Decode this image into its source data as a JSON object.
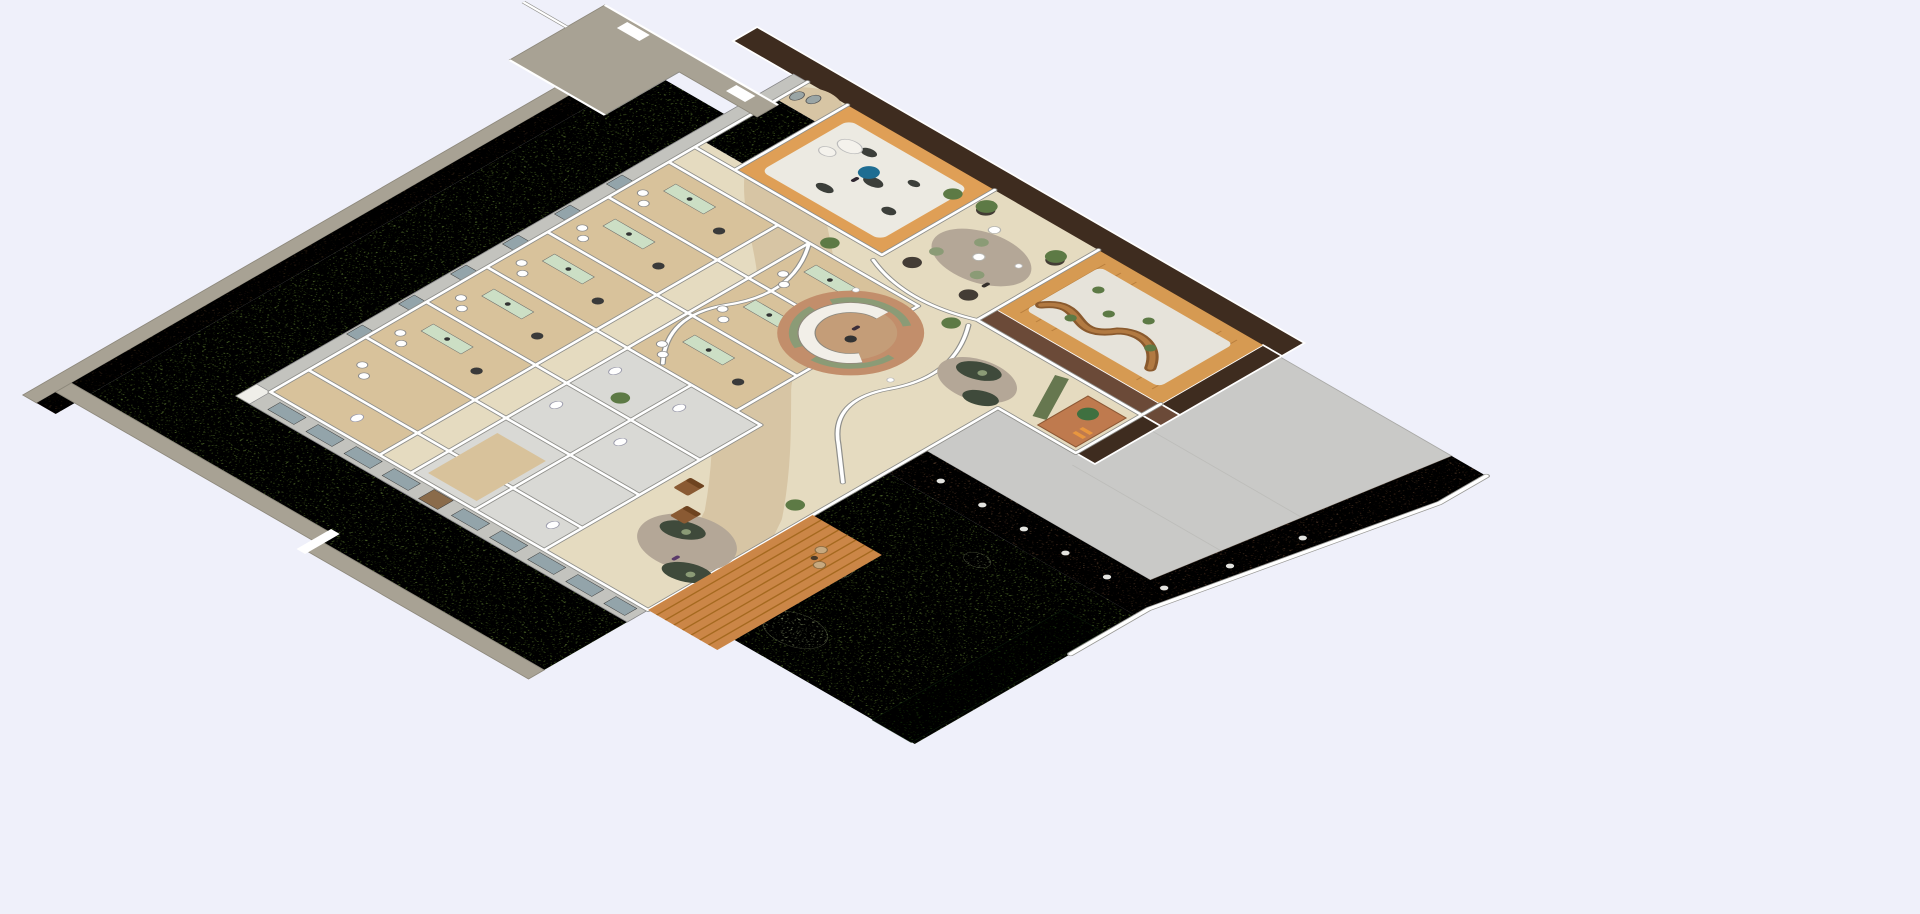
{
  "scene": {
    "type": "isometric-architectural-floor-plan-render",
    "subject": "single-storey clinic cutaway with consult-room wing, central lobby, circular reception desk, zen garden room, lounge, gravel courtyard, rear garden, concrete plaza and walled site perimeter",
    "visible_text": []
  },
  "palette": {
    "bg": "#eff0fa",
    "plaza": "#c9c9c7",
    "grass": "#7fa24b",
    "grassLight": "#b9ca92",
    "hedge": "#3a6022",
    "taupe": "#a8a294",
    "fenceBrown": "#55402c",
    "brickDark": "#3e2c1f",
    "brickRed": "#6b4a38",
    "extWall": "#c3c3be",
    "wallEdge": "#8f8f8b",
    "floorBeige": "#e5dbc0",
    "floorAccent": "#d7c5a4",
    "floorWood": "#d8c29b",
    "floorGray": "#d9d9d5",
    "gravel": "#eceae2",
    "courtGravel": "#e6e3da",
    "courtWood": "#d69a52",
    "zenWood": "#df9f56",
    "deck": "#cb8647",
    "deckLine": "#a5691f",
    "pebble": "#7b5a44",
    "rugTerra": "#c28e6b",
    "rugInner": "#c49d78",
    "rugTaupe": "#b4a797",
    "deskGreen": "#ccdfc5",
    "benchWood": "#8a5a2e",
    "sofaDark": "#3f4a3b",
    "chairBrown": "#8a5a33",
    "chairSage": "#8b9b76",
    "cabinetTerra": "#bf7a4e",
    "accentBlue": "#1e6d92",
    "olivePartition": "#66774f",
    "rock": "#3c3f3a",
    "plant": "#5d7a45",
    "white": "#ffffff",
    "window": "#93a4aa"
  },
  "zones": [
    {
      "name": "perimeter-fence-nw",
      "color_key": "fenceBrown"
    },
    {
      "name": "perimeter-fence-sw",
      "color_key": "taupe"
    },
    {
      "name": "lawn-l-strip",
      "color_key": "grass"
    },
    {
      "name": "entry-walkway",
      "color_key": "taupe"
    },
    {
      "name": "zen-garden-room",
      "color_key": "gravel"
    },
    {
      "name": "lounge-cafe",
      "color_key": "floorBeige"
    },
    {
      "name": "gravel-courtyard",
      "color_key": "courtGravel"
    },
    {
      "name": "kids-corner",
      "color_key": "cabinetTerra"
    },
    {
      "name": "lobby",
      "color_key": "floorBeige"
    },
    {
      "name": "reception-desk",
      "color_key": "rugTerra"
    },
    {
      "name": "consult-rooms-wing",
      "color_key": "floorWood"
    },
    {
      "name": "utility-block",
      "color_key": "floorGray"
    },
    {
      "name": "waiting-area",
      "color_key": "floorBeige"
    },
    {
      "name": "rear-garden",
      "color_key": "grass"
    },
    {
      "name": "timber-deck",
      "color_key": "deck"
    },
    {
      "name": "hedge",
      "color_key": "hedge"
    },
    {
      "name": "pebble-path",
      "color_key": "pebble"
    },
    {
      "name": "concrete-plaza",
      "color_key": "plaza"
    },
    {
      "name": "boundary-wall-white",
      "color_key": "white"
    }
  ]
}
